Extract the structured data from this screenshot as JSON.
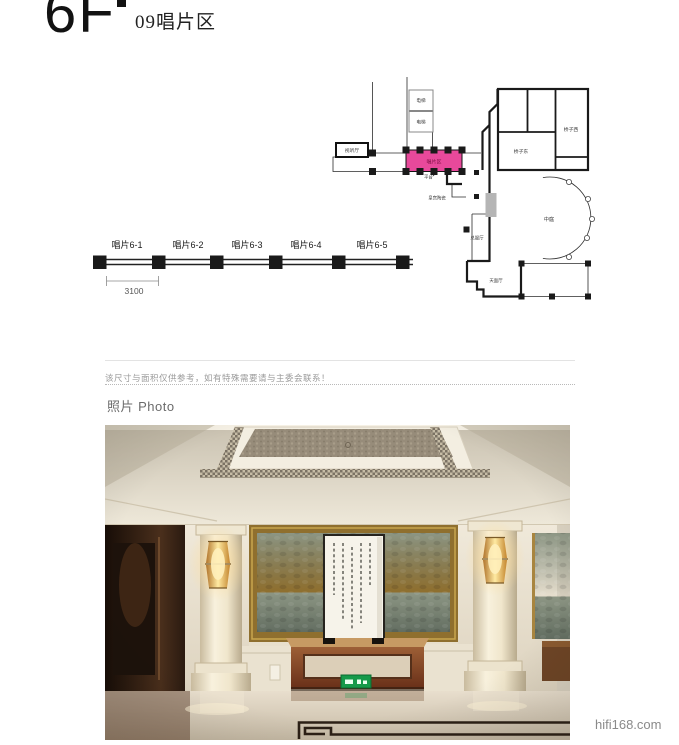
{
  "header": {
    "floor": "6F",
    "area_title": "09唱片区"
  },
  "plan": {
    "highlight_color": "#e8499b",
    "labels": {
      "elevator_top": "电梯",
      "elevator_bottom": "电梯",
      "av_hall": "视听厅",
      "record_area": "唱片区",
      "platform": "平台",
      "ceramics": "皇宫陶瓷",
      "bridge_west": "桥子西",
      "bridge_east": "桥子东",
      "atrium": "中庭",
      "service_hall": "总服厅",
      "sky_hall": "天面厅"
    }
  },
  "shops": {
    "labels": [
      "唱片6-1",
      "唱片6-2",
      "唱片6-3",
      "唱片6-4",
      "唱片6-5"
    ],
    "dimension": "3100"
  },
  "note": "该尺寸与面积仅供参考，如有特殊需要请与主委会联系！",
  "photo_section": {
    "heading_cn": "照片",
    "heading_en": "Photo"
  },
  "footer": {
    "watermark": "hifi168.com"
  }
}
